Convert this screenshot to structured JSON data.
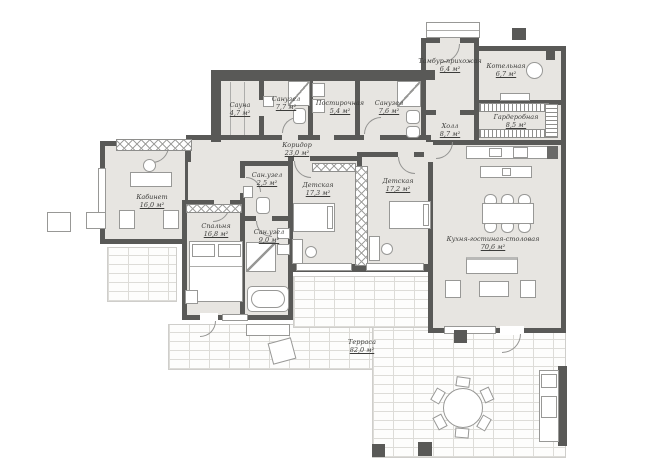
{
  "plan": {
    "rooms": [
      {
        "name": "Сауна",
        "area": "4,7 м²"
      },
      {
        "name": "Санузел",
        "area": "7,7 м²"
      },
      {
        "name": "Постирочная",
        "area": "5,4 м²"
      },
      {
        "name": "Санузел",
        "area": "7,6 м²"
      },
      {
        "name": "Тамбур-прихожая",
        "area": "6,4 м²"
      },
      {
        "name": "Котельная",
        "area": "6,7 м²"
      },
      {
        "name": "Гардеробная",
        "area": "8,5 м²"
      },
      {
        "name": "Холл",
        "area": "8,7 м²"
      },
      {
        "name": "Коридор",
        "area": "23,0 м²"
      },
      {
        "name": "Кабинет",
        "area": "16,0 м²"
      },
      {
        "name": "Спальня",
        "area": "16,8 м²"
      },
      {
        "name": "Сан.узел",
        "area": "2,5 м²"
      },
      {
        "name": "Сан.узел",
        "area": "9,0 м²"
      },
      {
        "name": "Детская",
        "area": "17,3 м²"
      },
      {
        "name": "Детская",
        "area": "17,2 м²"
      },
      {
        "name": "Кухня-гостиная-столовая",
        "area": "70,6 м²"
      },
      {
        "name": "Терраса",
        "area": "82,0 м²"
      }
    ],
    "colors": {
      "wall": "#595957",
      "floor": "#e7e5e1",
      "brick_line": "#dddcd8",
      "furniture_stroke": "#989896"
    }
  }
}
